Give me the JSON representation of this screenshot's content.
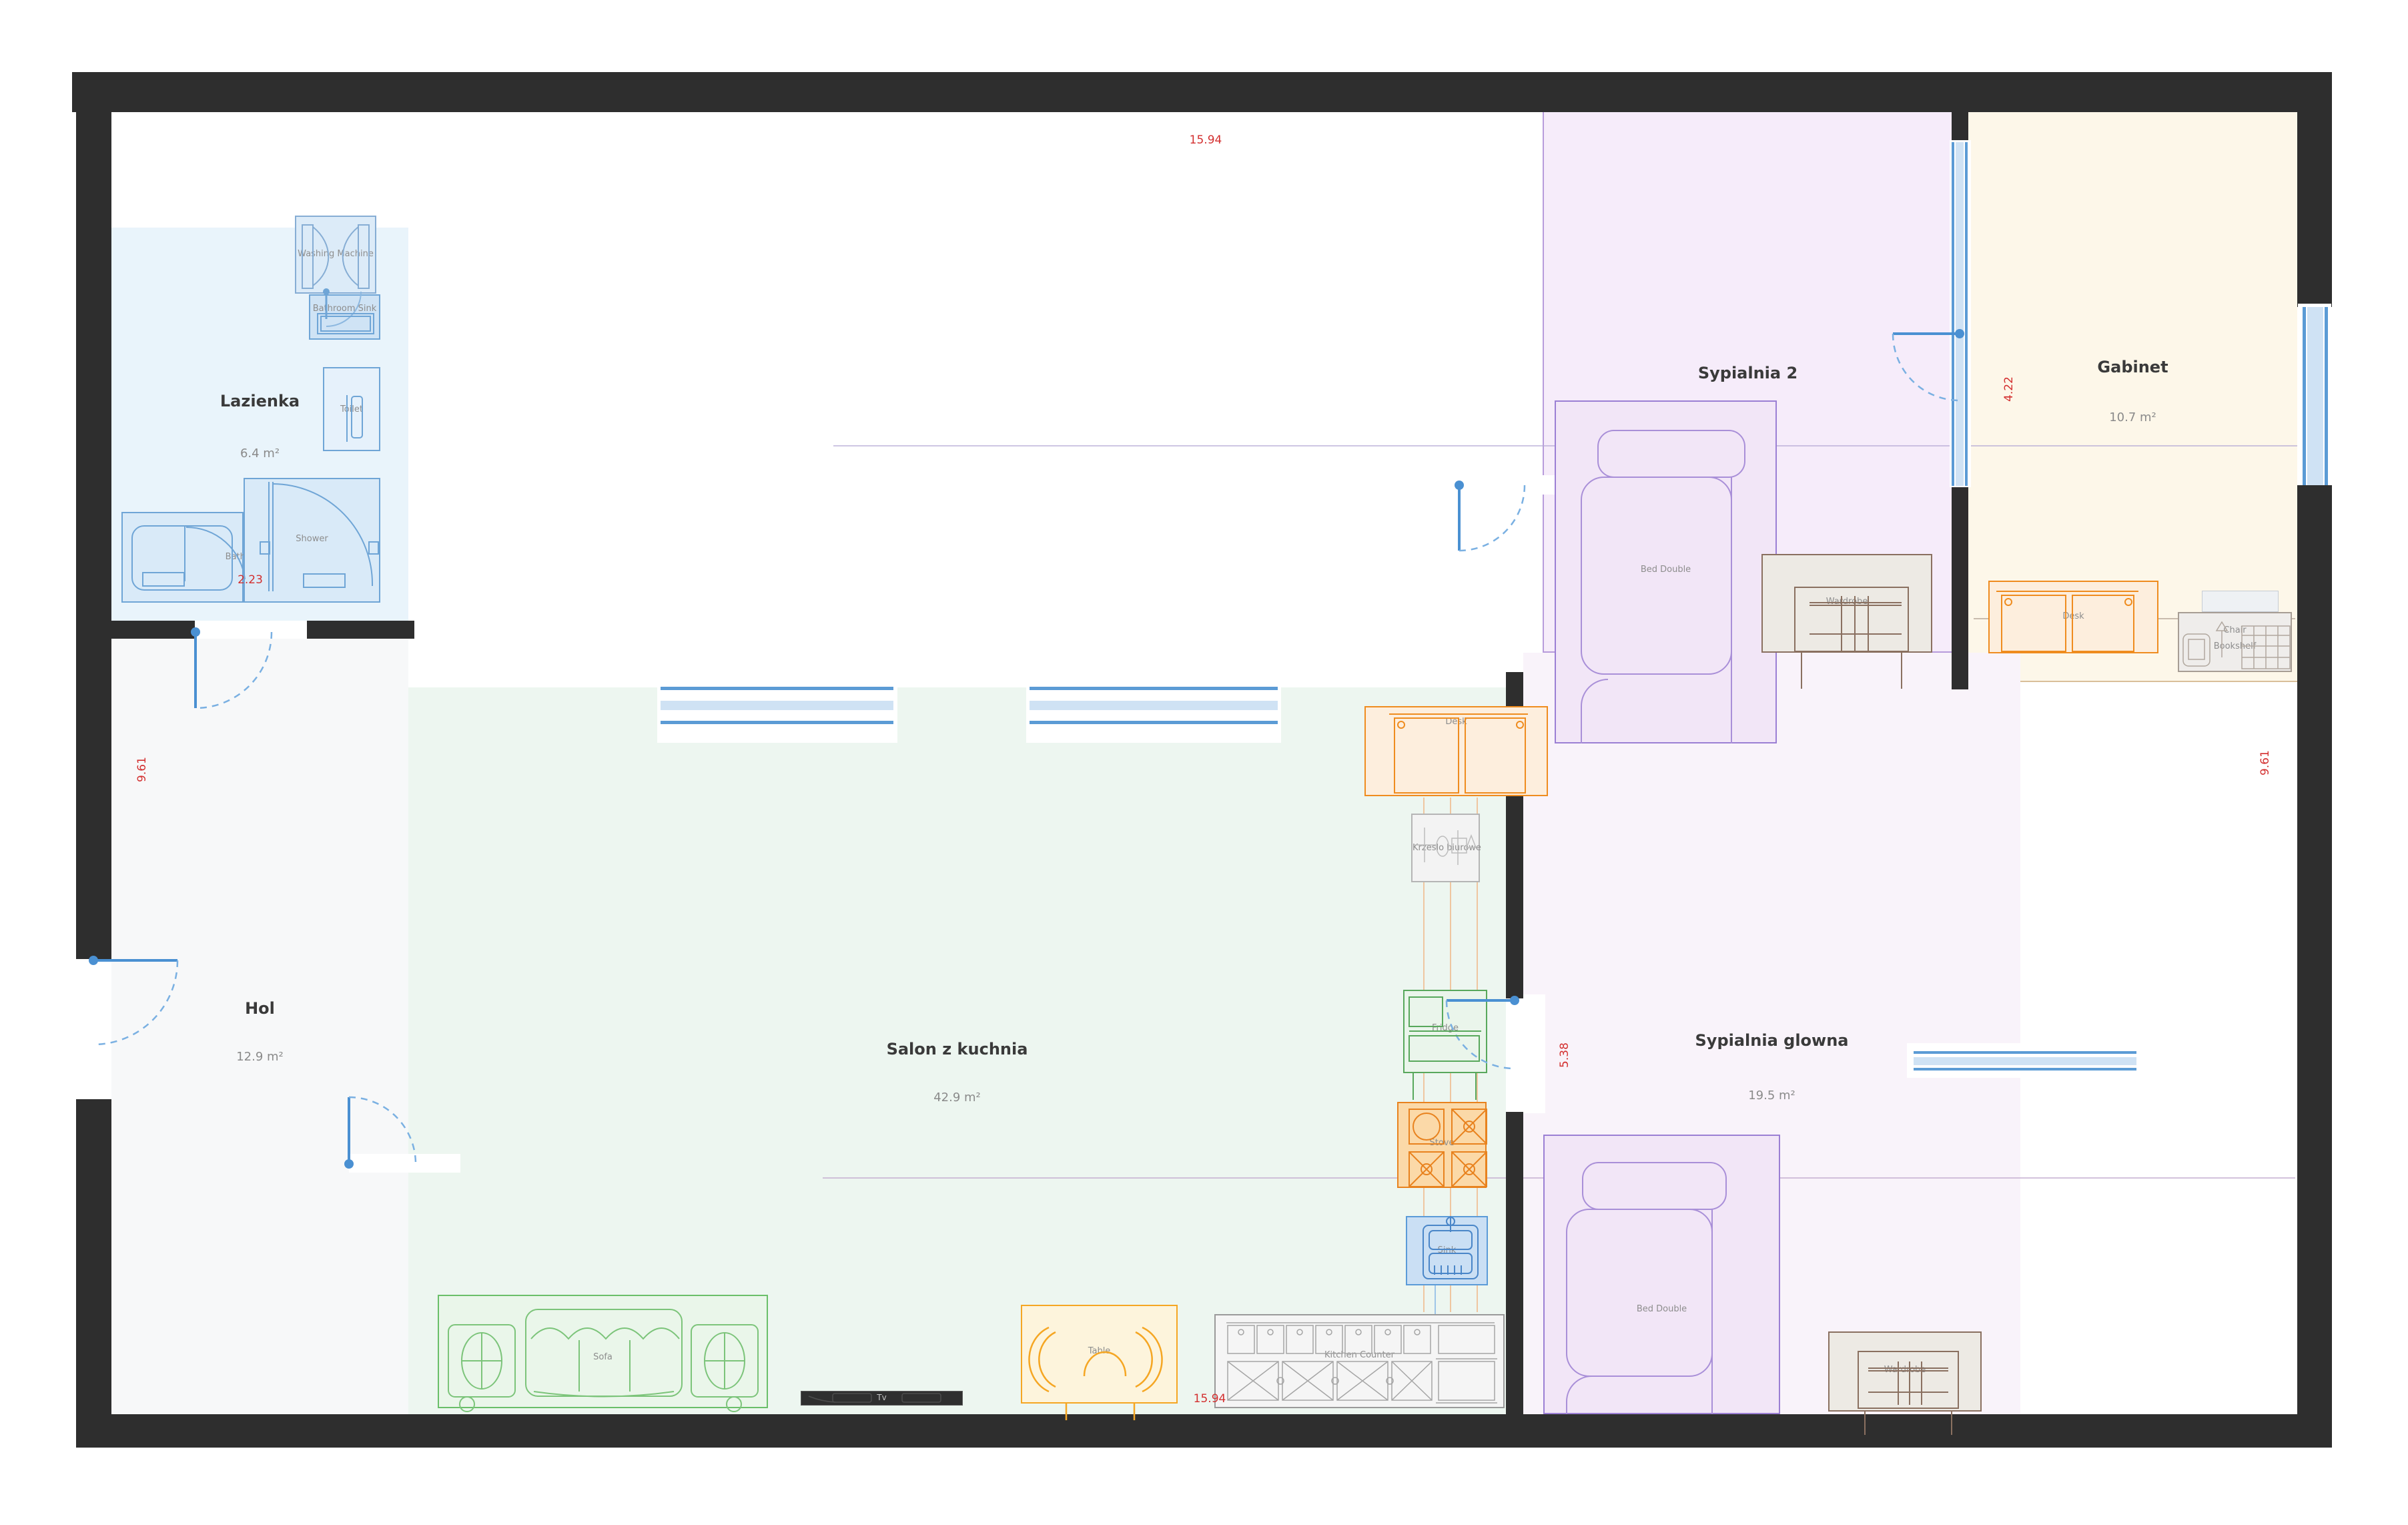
{
  "rooms": {
    "lazienka": {
      "name": "Lazienka",
      "area": "6.4 m²"
    },
    "hol": {
      "name": "Hol",
      "area": "12.9 m²"
    },
    "salon": {
      "name": "Salon z kuchnia",
      "area": "42.9 m²"
    },
    "sypialnia2": {
      "name": "Sypialnia 2",
      "area": "13.5 m²"
    },
    "gabinet": {
      "name": "Gabinet",
      "area": "10.7 m²"
    },
    "sypialnia_glowna": {
      "name": "Sypialnia glowna",
      "area": "19.5 m²"
    }
  },
  "furniture": {
    "washing_machine": {
      "label": "Washing Machine"
    },
    "bathroom_sink": {
      "label": "Bathroom Sink"
    },
    "toilet": {
      "label": "Toilet"
    },
    "bathtub": {
      "label": "Bathtub"
    },
    "shower": {
      "label": "Shower"
    },
    "desk_salon": {
      "label": "Desk"
    },
    "office_chair": {
      "label": "Krzeslo biurowe"
    },
    "fridge": {
      "label": "Fridge"
    },
    "stove": {
      "label": "Stove"
    },
    "sink": {
      "label": "Sink"
    },
    "sofa": {
      "label": "Sofa"
    },
    "table": {
      "label": "Table"
    },
    "tv": {
      "label": "Tv"
    },
    "kitchen_counter": {
      "label": "Kitchen Counter"
    },
    "bed_sypialnia2": {
      "label": "Bed Double"
    },
    "wardrobe_sypialnia2": {
      "label": "Wardrobe"
    },
    "desk_gabinet": {
      "label": "Desk"
    },
    "chair_gabinet": {
      "label": "Chair"
    },
    "bookshelf_gabinet": {
      "label": "Bookshelf"
    },
    "bed_glowna": {
      "label": "Bed Double"
    },
    "wardrobe_glowna": {
      "label": "Wardrobe"
    }
  },
  "dimensions": {
    "top": "15.94",
    "bottom": "15.94",
    "left": "9.61",
    "right": "9.61",
    "bathroom": "2.23",
    "gabinet_side": "4.22",
    "salon_side": "5.38"
  },
  "colors": {
    "wall": "#2e2e2e",
    "door": "#4a90d2",
    "window": "#5b9bd5",
    "dimension_text": "#d32f2f",
    "lazienka_fill": "#e9f4fb",
    "hol_fill": "#f7f8f9",
    "salon_fill": "#edf6f0",
    "sypialnia2_fill": "#f6ecfa",
    "gabinet_fill": "#fdf7e9",
    "sypialnia_glowna_fill": "#f9f3fa",
    "blue_fixture": "#6fa5d6",
    "orange_furniture": "#ef8c1f",
    "green_furniture": "#6abf69",
    "purple_furniture": "#9b7fd4",
    "brown_furniture": "#8a7060"
  }
}
